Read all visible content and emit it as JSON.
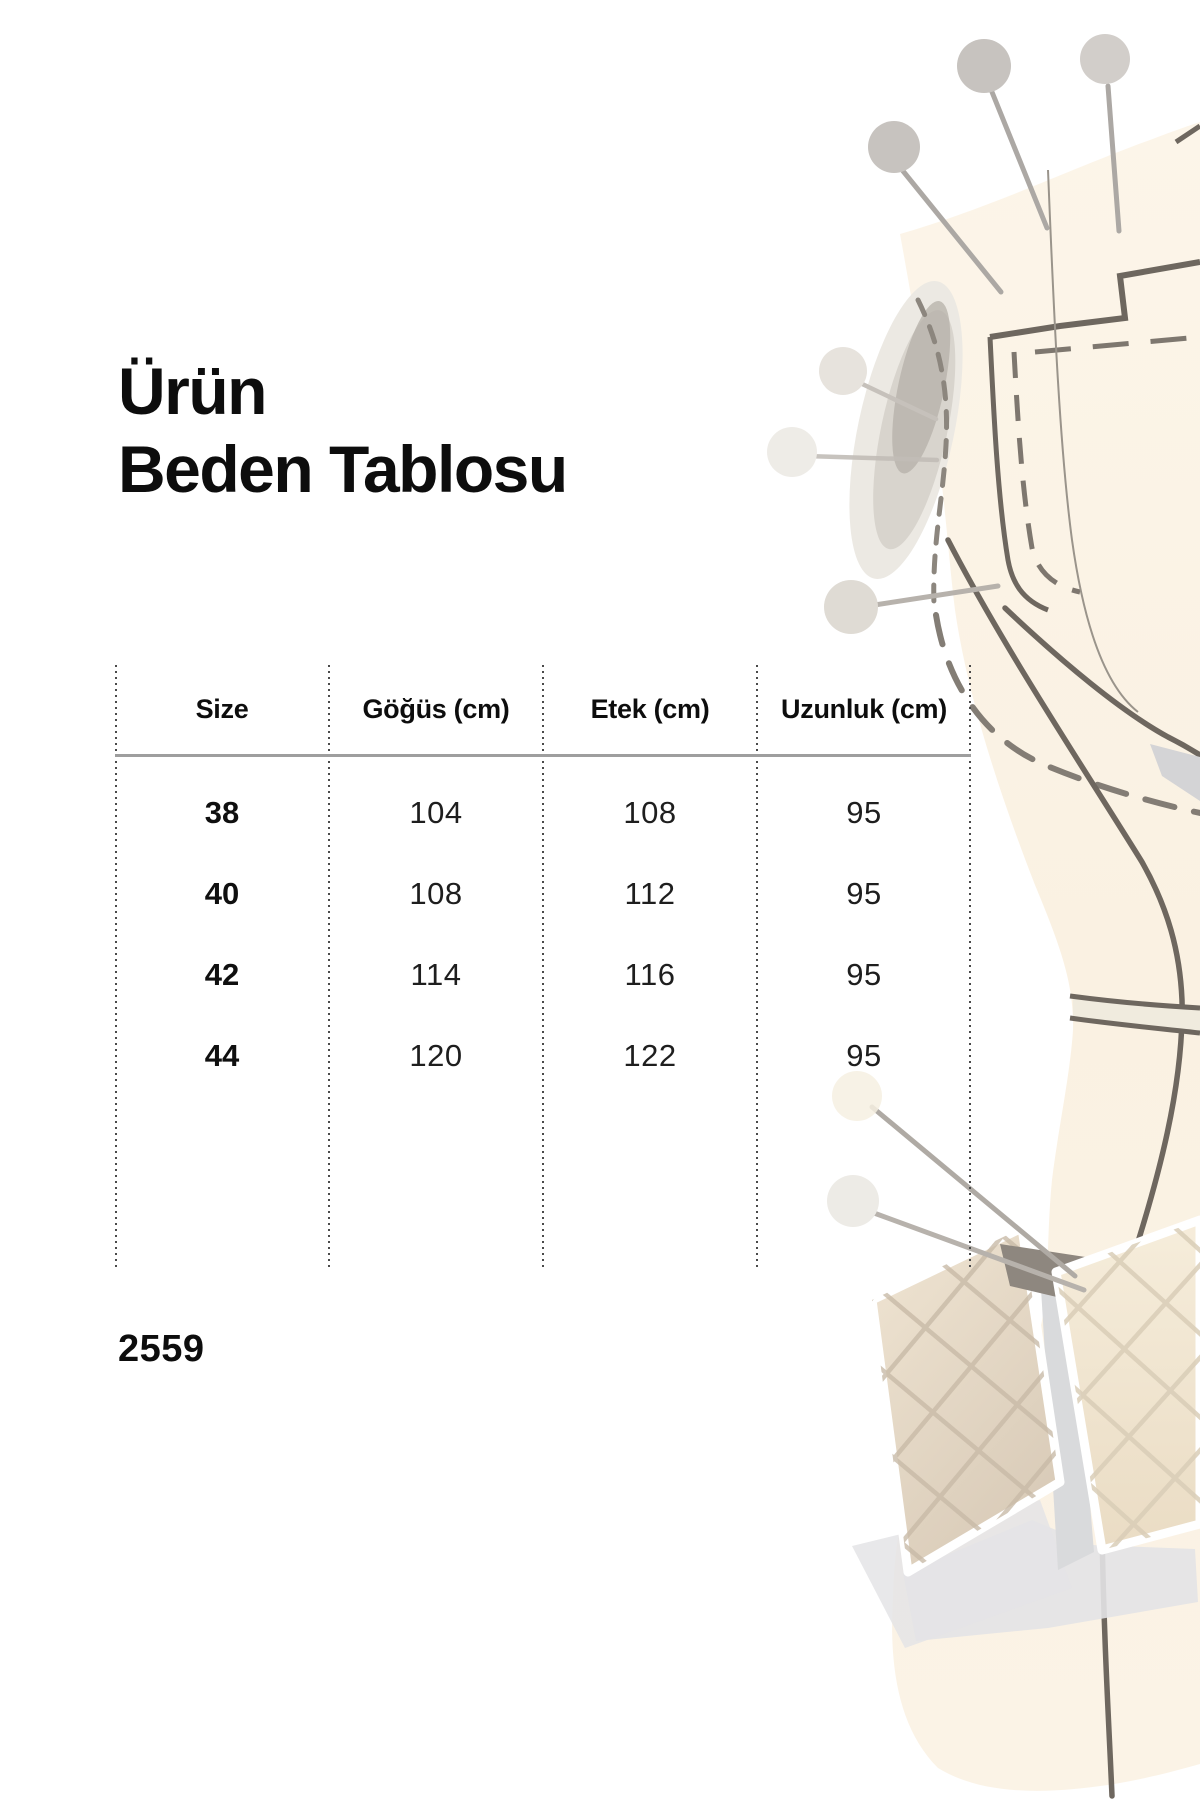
{
  "page": {
    "title_line1": "Ürün",
    "title_line2": "Beden Tablosu",
    "product_code": "2559"
  },
  "size_table": {
    "columns": [
      "Size",
      "Göğüs (cm)",
      "Etek (cm)",
      "Uzunluk (cm)"
    ],
    "rows": [
      {
        "size": "38",
        "gogus": "104",
        "etek": "108",
        "uzunluk": "95"
      },
      {
        "size": "40",
        "gogus": "108",
        "etek": "112",
        "uzunluk": "95"
      },
      {
        "size": "42",
        "gogus": "114",
        "etek": "116",
        "uzunluk": "95"
      },
      {
        "size": "44",
        "gogus": "120",
        "etek": "122",
        "uzunluk": "95"
      }
    ]
  },
  "illustration": {
    "name": "tailor-dress-form-with-pins",
    "colors": {
      "fabric_cream": "#FAF1E2",
      "seam_outline": "#6E675F",
      "stitch_dash": "#8C867E",
      "pin_gray": "#C7C3BF",
      "patch_beige": "#E2D4C0",
      "shadow_gray": "#E3E3E5"
    }
  }
}
